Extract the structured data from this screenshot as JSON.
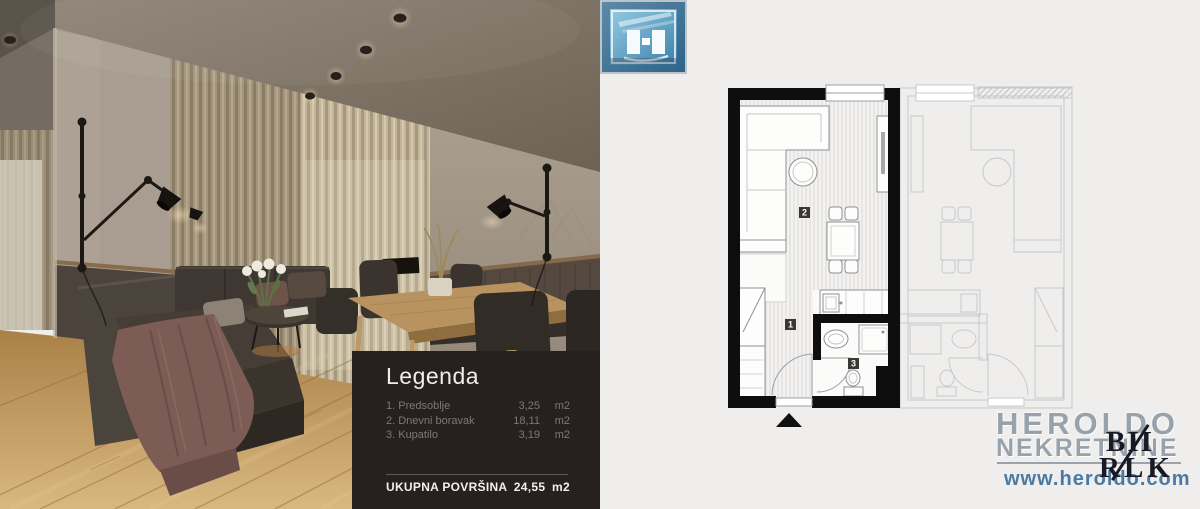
{
  "legend": {
    "title": "Legenda",
    "items": [
      {
        "label": "1. Predsoblje",
        "value": "3,25",
        "unit": "m2"
      },
      {
        "label": "2. Dnevni boravak",
        "value": "18,11",
        "unit": "m2"
      },
      {
        "label": "3. Kupatilo",
        "value": "3,19",
        "unit": "m2"
      }
    ],
    "total_label": "UKUPNA POVRŠINA",
    "total_value": "24,55",
    "total_unit": "m2"
  },
  "floor_plan": {
    "badges": [
      "1",
      "2",
      "3"
    ],
    "wall_color": "#0e0e0e",
    "adjacent_unit_color": "#c6c9cc",
    "entrance_marker": "triangle"
  },
  "branding": {
    "name_line1": "HEROLDO",
    "name_line2": "NEKRETNINE",
    "website": "www.heroldo.com",
    "watermark_line1": "BII",
    "watermark_line2": "RLK",
    "logo_icon": "building-h-icon",
    "brand_text_color": "#98a2ad",
    "website_color": "#4a7aa3",
    "icon_blue": "#4186ad"
  },
  "colors": {
    "plan_background": "#efeeec",
    "legend_background": "#262120",
    "legend_muted_text": "#7e7873",
    "legend_bright_text": "#f2efec",
    "wood_floor": "#c9a76b",
    "blanket_mauve": "#7c5c55"
  }
}
